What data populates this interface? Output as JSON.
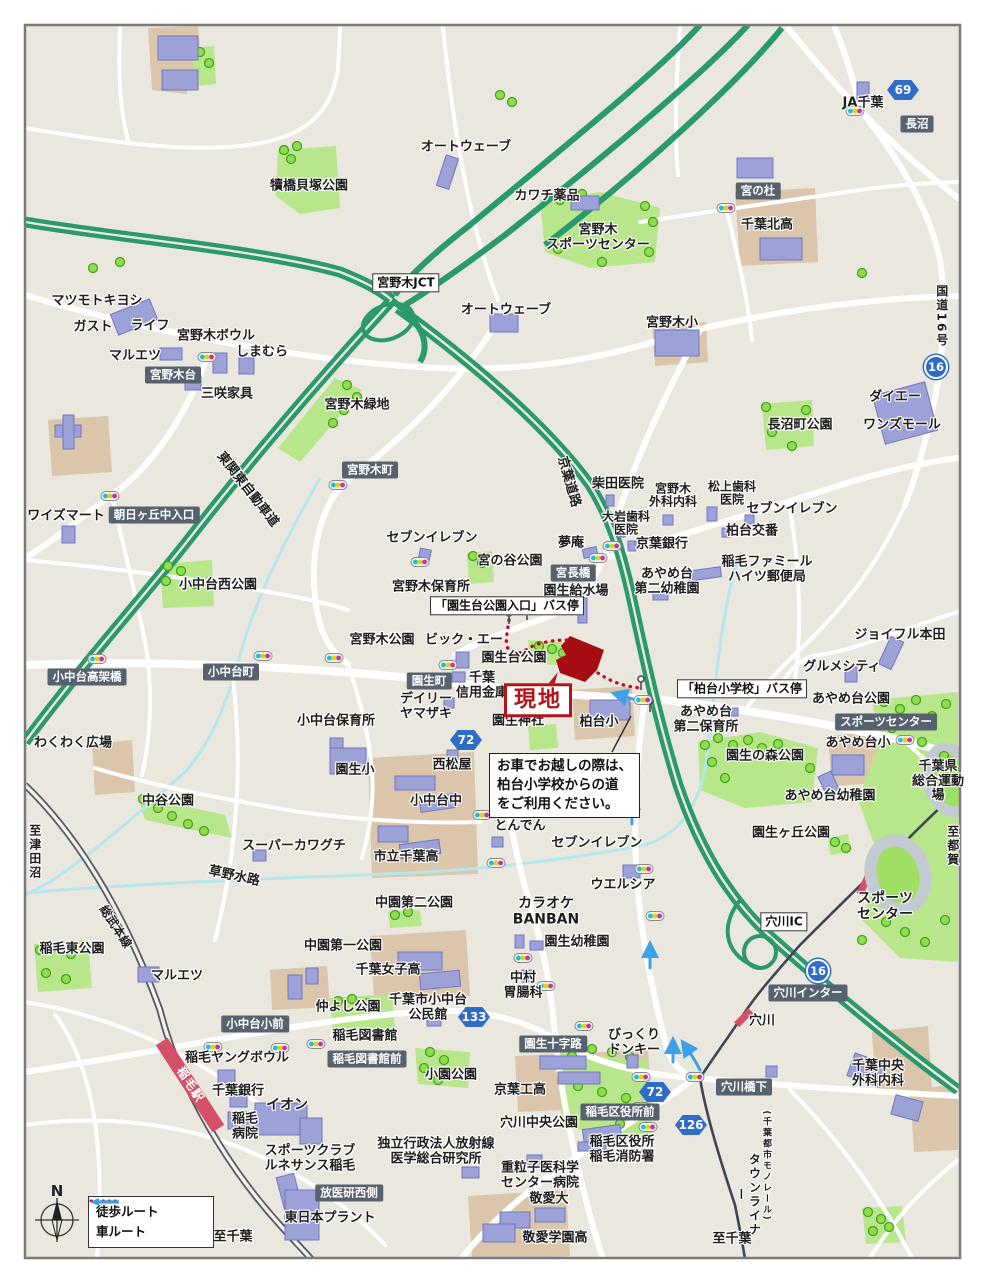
{
  "legend": {
    "walk": "徒歩ルート",
    "car": "車ルート"
  },
  "compass_n": "N",
  "site": {
    "label": "現地"
  },
  "note": {
    "text": "お車でお越しの際は、\n柏台小学校からの道\nをご利用ください。"
  },
  "labels": [
    {
      "t": "犢橋貝塚公園",
      "x": 309,
      "y": 187
    },
    {
      "t": "オートウェーブ",
      "x": 466,
      "y": 148
    },
    {
      "t": "カワチ薬品",
      "x": 547,
      "y": 197
    },
    {
      "t": "宮野木\nスポーツセンター",
      "x": 598,
      "y": 238
    },
    {
      "t": "JA千葉",
      "x": 863,
      "y": 104
    },
    {
      "t": "69",
      "x": 903,
      "y": 90,
      "k": "s"
    },
    {
      "t": "長沼",
      "x": 917,
      "y": 124,
      "k": "b"
    },
    {
      "t": "宮の杜",
      "x": 758,
      "y": 191,
      "k": "b"
    },
    {
      "t": "千葉北高",
      "x": 767,
      "y": 226
    },
    {
      "t": "宮野木JCT",
      "x": 406,
      "y": 283,
      "k": "w"
    },
    {
      "t": "オートウェーブ",
      "x": 506,
      "y": 311
    },
    {
      "t": "宮野木小",
      "x": 672,
      "y": 324
    },
    {
      "t": "国道16号",
      "x": 941,
      "y": 316,
      "k": "v",
      "fs": 12
    },
    {
      "t": "16",
      "x": 936,
      "y": 367,
      "k": "c"
    },
    {
      "t": "マツモトキヨシ",
      "x": 97,
      "y": 302
    },
    {
      "t": "ガスト",
      "x": 93,
      "y": 328
    },
    {
      "t": "ライフ",
      "x": 150,
      "y": 327
    },
    {
      "t": "宮野木ボウル",
      "x": 216,
      "y": 337
    },
    {
      "t": "マルエツ",
      "x": 135,
      "y": 357
    },
    {
      "t": "しまむら",
      "x": 262,
      "y": 353
    },
    {
      "t": "宮野木台",
      "x": 173,
      "y": 375,
      "k": "b"
    },
    {
      "t": "三咲家具",
      "x": 227,
      "y": 395
    },
    {
      "t": "宮野木緑地",
      "x": 357,
      "y": 406
    },
    {
      "t": "長沼町公園",
      "x": 800,
      "y": 426
    },
    {
      "t": "ダイエー",
      "x": 895,
      "y": 398
    },
    {
      "t": "ワンズモール",
      "x": 902,
      "y": 426
    },
    {
      "t": "東関東自動車道",
      "x": 247,
      "y": 490,
      "r": 52
    },
    {
      "t": "宮野木町",
      "x": 370,
      "y": 470,
      "k": "b"
    },
    {
      "t": "京葉道路",
      "x": 568,
      "y": 482,
      "r": 74
    },
    {
      "t": "柴田医院",
      "x": 618,
      "y": 485
    },
    {
      "t": "宮野木\n外科内科",
      "x": 673,
      "y": 496,
      "fs": 12
    },
    {
      "t": "松上歯科\n医院",
      "x": 732,
      "y": 494,
      "fs": 12
    },
    {
      "t": "セブンイレブン",
      "x": 792,
      "y": 510
    },
    {
      "t": "大岩歯科\n医院",
      "x": 626,
      "y": 524,
      "fs": 12
    },
    {
      "t": "夢庵",
      "x": 571,
      "y": 544
    },
    {
      "t": "京葉銀行",
      "x": 662,
      "y": 545
    },
    {
      "t": "柏台交番",
      "x": 752,
      "y": 532
    },
    {
      "t": "ワイズマート",
      "x": 66,
      "y": 517
    },
    {
      "t": "朝日ヶ丘中入口",
      "x": 154,
      "y": 515,
      "k": "b"
    },
    {
      "t": "稲毛ファミール\nハイツ郵便局",
      "x": 767,
      "y": 570
    },
    {
      "t": "セブンイレブン",
      "x": 432,
      "y": 539
    },
    {
      "t": "宮の谷公園",
      "x": 510,
      "y": 562
    },
    {
      "t": "宮長橋",
      "x": 573,
      "y": 573,
      "k": "b"
    },
    {
      "t": "小中台西公園",
      "x": 218,
      "y": 586
    },
    {
      "t": "宮野木保育所",
      "x": 431,
      "y": 588
    },
    {
      "t": "園生給水場",
      "x": 576,
      "y": 592
    },
    {
      "t": "あやめ台\n第二幼稚園",
      "x": 667,
      "y": 582
    },
    {
      "t": "「園生台公園入口」バス停",
      "x": 507,
      "y": 606,
      "k": "w"
    },
    {
      "t": "宮野木公園",
      "x": 382,
      "y": 641
    },
    {
      "t": "ビック・エー",
      "x": 464,
      "y": 641
    },
    {
      "t": "園生台公園",
      "x": 514,
      "y": 659
    },
    {
      "t": "ジョイフル本田",
      "x": 900,
      "y": 636
    },
    {
      "t": "グルメシティ",
      "x": 842,
      "y": 668
    },
    {
      "t": "小中台高架橋",
      "x": 87,
      "y": 677,
      "k": "b"
    },
    {
      "t": "小中台町",
      "x": 231,
      "y": 672,
      "k": "b"
    },
    {
      "t": "園生町",
      "x": 429,
      "y": 681,
      "k": "b"
    },
    {
      "t": "千葉\n信用金庫",
      "x": 482,
      "y": 686
    },
    {
      "t": "「柏台小学校」バス停",
      "x": 742,
      "y": 689,
      "k": "w"
    },
    {
      "t": "あやめ台公園",
      "x": 851,
      "y": 700
    },
    {
      "t": "スポーツセンター",
      "x": 886,
      "y": 722,
      "k": "b"
    },
    {
      "t": "わくわく広場",
      "x": 73,
      "y": 744
    },
    {
      "t": "小中台保育所",
      "x": 336,
      "y": 722
    },
    {
      "t": "デイリー\nヤマザキ",
      "x": 426,
      "y": 707
    },
    {
      "t": "72",
      "x": 466,
      "y": 740,
      "k": "s"
    },
    {
      "t": "園生神社",
      "x": 518,
      "y": 722
    },
    {
      "t": "柏台小",
      "x": 599,
      "y": 723
    },
    {
      "t": "あやめ台\n第二保育所",
      "x": 706,
      "y": 720
    },
    {
      "t": "園生の森公園",
      "x": 765,
      "y": 757
    },
    {
      "t": "あやめ台小",
      "x": 858,
      "y": 744
    },
    {
      "t": "千葉県\n総合運動場",
      "x": 938,
      "y": 782
    },
    {
      "t": "中谷公園",
      "x": 168,
      "y": 802
    },
    {
      "t": "園生小",
      "x": 355,
      "y": 771
    },
    {
      "t": "西松屋",
      "x": 452,
      "y": 766
    },
    {
      "t": "小中台中",
      "x": 436,
      "y": 802
    },
    {
      "t": "あやめ台幼稚園",
      "x": 830,
      "y": 797
    },
    {
      "t": "スーパーカワグチ",
      "x": 294,
      "y": 847
    },
    {
      "t": "市立千葉高",
      "x": 406,
      "y": 858
    },
    {
      "t": "とんでん",
      "x": 520,
      "y": 827
    },
    {
      "t": "園生ヶ丘公園",
      "x": 791,
      "y": 834
    },
    {
      "t": "セブンイレブン",
      "x": 597,
      "y": 844
    },
    {
      "t": "至都賀",
      "x": 952,
      "y": 846,
      "k": "v",
      "fs": 12
    },
    {
      "t": "草野水路",
      "x": 234,
      "y": 877,
      "r": 12
    },
    {
      "t": "ウエルシア",
      "x": 623,
      "y": 886
    },
    {
      "t": "スポーツ\nセンター",
      "x": 885,
      "y": 907,
      "fs": 14,
      "cls": "bold2"
    },
    {
      "t": "穴川IC",
      "x": 784,
      "y": 922,
      "k": "w"
    },
    {
      "t": "中園第二公園",
      "x": 414,
      "y": 904
    },
    {
      "t": "カラオケ\nBANBAN",
      "x": 546,
      "y": 912,
      "fs": 14
    },
    {
      "t": "稲毛東公園",
      "x": 72,
      "y": 950
    },
    {
      "t": "マルエツ",
      "x": 177,
      "y": 977
    },
    {
      "t": "中園第一公園",
      "x": 343,
      "y": 947
    },
    {
      "t": "千葉女子高",
      "x": 388,
      "y": 971
    },
    {
      "t": "園生幼稚園",
      "x": 577,
      "y": 943
    },
    {
      "t": "16",
      "x": 818,
      "y": 971,
      "k": "c"
    },
    {
      "t": "穴川インター",
      "x": 808,
      "y": 993,
      "k": "b"
    },
    {
      "t": "中村\n胃腸科",
      "x": 523,
      "y": 986
    },
    {
      "t": "仲よし公園",
      "x": 348,
      "y": 1008
    },
    {
      "t": "千葉市小中台\n公民館",
      "x": 428,
      "y": 1008
    },
    {
      "t": "133",
      "x": 474,
      "y": 1017,
      "k": "s"
    },
    {
      "t": "小中台小前",
      "x": 255,
      "y": 1024,
      "k": "b"
    },
    {
      "t": "園生十字路",
      "x": 553,
      "y": 1044,
      "k": "b"
    },
    {
      "t": "びっくり\nドンキー",
      "x": 634,
      "y": 1043
    },
    {
      "t": "穴川",
      "x": 762,
      "y": 1022
    },
    {
      "t": "稲毛ヤングボウル",
      "x": 237,
      "y": 1059
    },
    {
      "t": "稲毛図書館",
      "x": 365,
      "y": 1037
    },
    {
      "t": "稲毛図書館前",
      "x": 367,
      "y": 1059,
      "k": "b"
    },
    {
      "t": "小園公園",
      "x": 451,
      "y": 1076
    },
    {
      "t": "京葉工高",
      "x": 520,
      "y": 1091
    },
    {
      "t": "穴川橋下",
      "x": 744,
      "y": 1087,
      "k": "b"
    },
    {
      "t": "千葉中央\n外科内科",
      "x": 878,
      "y": 1074
    },
    {
      "t": "72",
      "x": 655,
      "y": 1092,
      "k": "s"
    },
    {
      "t": "千葉銀行",
      "x": 238,
      "y": 1092
    },
    {
      "t": "イオン",
      "x": 287,
      "y": 1106,
      "fs": 14
    },
    {
      "t": "126",
      "x": 691,
      "y": 1125,
      "k": "s"
    },
    {
      "t": "稲毛区役所前",
      "x": 620,
      "y": 1112,
      "k": "b"
    },
    {
      "t": "穴川中央公園",
      "x": 539,
      "y": 1124
    },
    {
      "t": "稲毛駅",
      "x": 190,
      "y": 1085,
      "r": 57,
      "k": "t"
    },
    {
      "t": "稲毛\n病院",
      "x": 245,
      "y": 1127
    },
    {
      "t": "スポーツクラブ\nルネサンス稲毛",
      "x": 310,
      "y": 1159
    },
    {
      "t": "独立行政法人放射線\n医学総合研究所",
      "x": 436,
      "y": 1152
    },
    {
      "t": "重粒子医科学\nセンター病院",
      "x": 540,
      "y": 1176
    },
    {
      "t": "稲毛区役所\n稲毛消防署",
      "x": 622,
      "y": 1150
    },
    {
      "t": "放医研西側",
      "x": 349,
      "y": 1193,
      "k": "b"
    },
    {
      "t": "敬愛大",
      "x": 549,
      "y": 1200
    },
    {
      "t": "東日本プラント",
      "x": 330,
      "y": 1219
    },
    {
      "t": "敬愛学園高",
      "x": 555,
      "y": 1239
    },
    {
      "t": "至千葉",
      "x": 233,
      "y": 1238
    },
    {
      "t": "至千葉",
      "x": 732,
      "y": 1240
    },
    {
      "t": "至津田沼",
      "x": 34,
      "y": 852,
      "k": "v",
      "fs": 12
    },
    {
      "t": "総武本線",
      "x": 115,
      "y": 927,
      "r": 57,
      "fs": 12
    },
    {
      "t": "(千葉都市モノレール)",
      "x": 766,
      "y": 1166,
      "k": "v",
      "fs": 9
    },
    {
      "t": "タウンライナー",
      "x": 747,
      "y": 1195,
      "k": "v",
      "fs": 12
    }
  ]
}
